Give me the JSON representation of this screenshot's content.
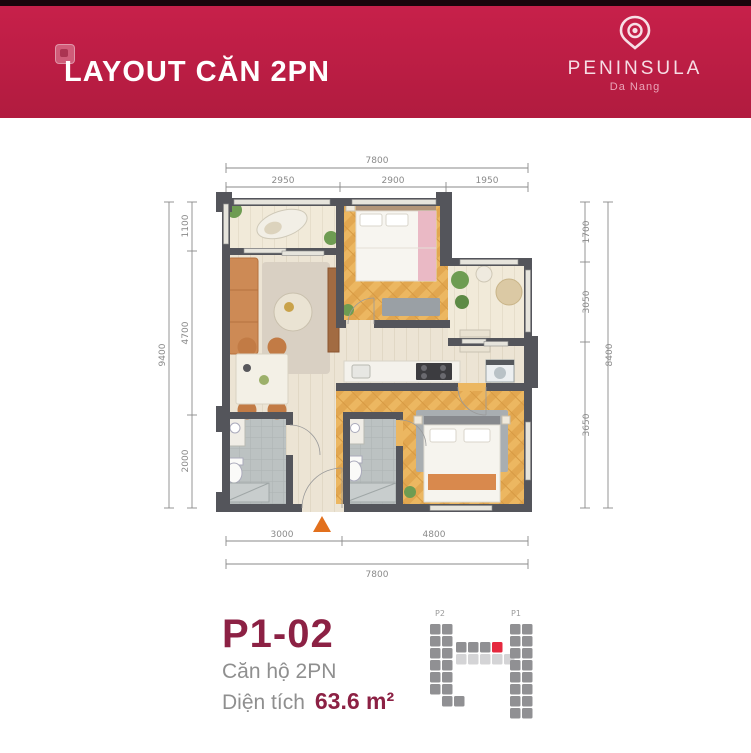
{
  "colors": {
    "header_bg": "#c7204a",
    "header_bg_dark": "#b11b3f",
    "brand_text": "#f6dde4",
    "brand_sub": "#eaa4b8",
    "maroon": "#8c2144",
    "gray_text": "#8f8f8f",
    "wall": "#54555b",
    "dim": "#8a8a8a",
    "arrow_orange": "#e2701d",
    "site_cell": "#909093",
    "site_cell_light": "#d4d4d6",
    "site_cell_red": "#e5293e"
  },
  "header": {
    "title": "LAYOUT CĂN 2PN",
    "brand": "PENINSULA",
    "brand_sub": "Da Nang"
  },
  "plan": {
    "dims": {
      "top_total": "7800",
      "top": [
        "2950",
        "2900",
        "1950"
      ],
      "bottom": [
        "3000",
        "4800"
      ],
      "bottom_total": "7800",
      "left": [
        "1100",
        "4700",
        "2000"
      ],
      "left_total": "9400",
      "right": [
        "1700",
        "3050",
        "3650"
      ],
      "right_total": "8400"
    }
  },
  "unit": {
    "code": "P1-02",
    "type": "Căn hộ 2PN",
    "area_label": "Diện tích",
    "area_value": "63.6 m²"
  },
  "site_plan": {
    "labels": {
      "left": "P2",
      "right": "P1"
    }
  }
}
